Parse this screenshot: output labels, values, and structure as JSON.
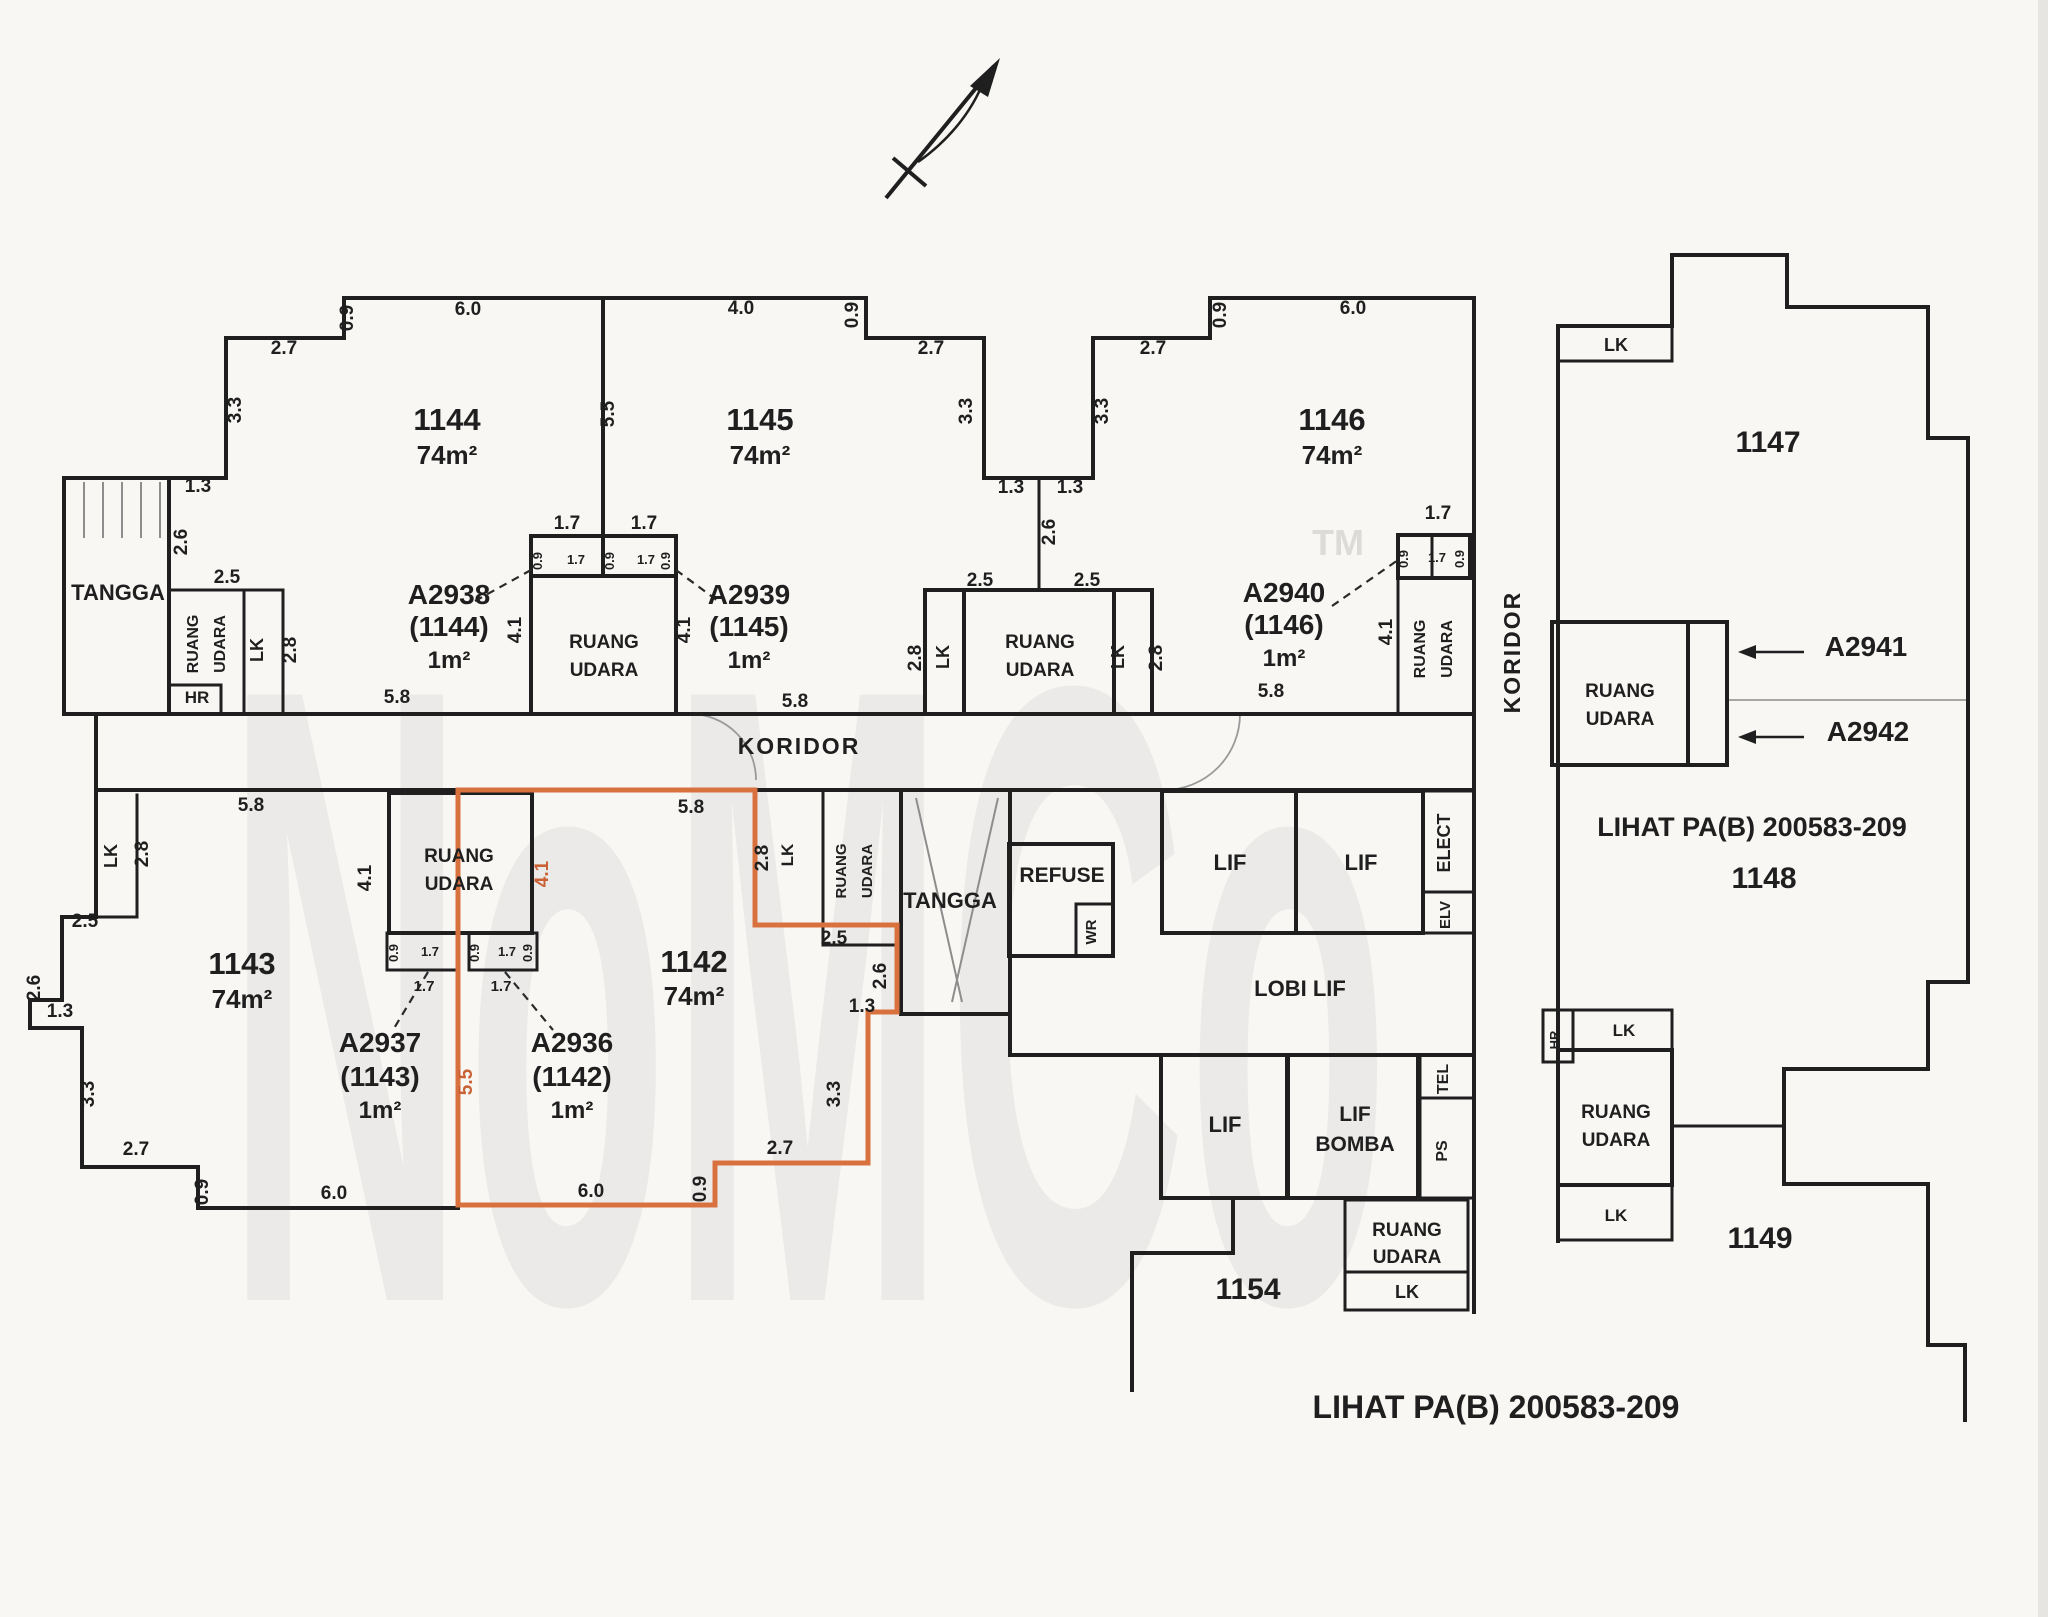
{
  "palette": {
    "ink": "#1f1f1f",
    "boundary": "#c96135",
    "muted": "#9a9a9a",
    "paper": "#f8f7f4"
  },
  "watermark": {
    "text": "NoMCo",
    "tm": "TM"
  },
  "notes": {
    "right_reference": "LIHAT PA(B) 200583-209",
    "bottom_reference": "LIHAT PA(B) 200583-209"
  },
  "units_summary": [
    {
      "id": "1144",
      "area": "74m²",
      "accessory": "A2938 (1144) 1m²"
    },
    {
      "id": "1145",
      "area": "74m²",
      "accessory": "A2939 (1145) 1m²"
    },
    {
      "id": "1146",
      "area": "74m²",
      "accessory": "A2940 (1146) 1m²"
    },
    {
      "id": "1143",
      "area": "74m²",
      "accessory": "A2937 (1143) 1m²"
    },
    {
      "id": "1142",
      "area": "74m²",
      "accessory": "A2936 (1142) 1m²",
      "highlighted": true
    },
    {
      "id": "1147"
    },
    {
      "id": "1148"
    },
    {
      "id": "1149"
    },
    {
      "id": "1154"
    }
  ],
  "labels": [
    {
      "n": "unit-1144-number",
      "t": "1144",
      "x": 447,
      "y": 430,
      "s": 31
    },
    {
      "n": "unit-1144-area",
      "t": "74m²",
      "x": 447,
      "y": 464,
      "s": 26
    },
    {
      "n": "unit-1145-number",
      "t": "1145",
      "x": 760,
      "y": 430,
      "s": 31
    },
    {
      "n": "unit-1145-area",
      "t": "74m²",
      "x": 760,
      "y": 464,
      "s": 26
    },
    {
      "n": "unit-1146-number",
      "t": "1146",
      "x": 1332,
      "y": 430,
      "s": 31
    },
    {
      "n": "unit-1146-area",
      "t": "74m²",
      "x": 1332,
      "y": 464,
      "s": 26
    },
    {
      "n": "unit-1147-number",
      "t": "1147",
      "x": 1768,
      "y": 452,
      "s": 30
    },
    {
      "n": "unit-1148-number",
      "t": "1148",
      "x": 1764,
      "y": 888,
      "s": 30
    },
    {
      "n": "unit-1149-number",
      "t": "1149",
      "x": 1760,
      "y": 1248,
      "s": 30
    },
    {
      "n": "unit-1154-number",
      "t": "1154",
      "x": 1248,
      "y": 1299,
      "s": 30
    },
    {
      "n": "unit-1143-number",
      "t": "1143",
      "x": 242,
      "y": 974,
      "s": 31
    },
    {
      "n": "unit-1143-area",
      "t": "74m²",
      "x": 242,
      "y": 1008,
      "s": 26
    },
    {
      "n": "unit-1142-number",
      "t": "1142",
      "x": 694,
      "y": 972,
      "s": 31
    },
    {
      "n": "unit-1142-area",
      "t": "74m²",
      "x": 694,
      "y": 1005,
      "s": 26
    },
    {
      "n": "accessory-a2938",
      "t": "A2938",
      "x": 449,
      "y": 604,
      "s": 28
    },
    {
      "n": "accessory-a2938-unit",
      "t": "(1144)",
      "x": 449,
      "y": 636,
      "s": 28
    },
    {
      "n": "accessory-a2938-area",
      "t": "1m²",
      "x": 449,
      "y": 668,
      "s": 24
    },
    {
      "n": "accessory-a2939",
      "t": "A2939",
      "x": 749,
      "y": 604,
      "s": 28
    },
    {
      "n": "accessory-a2939-unit",
      "t": "(1145)",
      "x": 749,
      "y": 636,
      "s": 28
    },
    {
      "n": "accessory-a2939-area",
      "t": "1m²",
      "x": 749,
      "y": 668,
      "s": 24
    },
    {
      "n": "accessory-a2940",
      "t": "A2940",
      "x": 1284,
      "y": 602,
      "s": 28
    },
    {
      "n": "accessory-a2940-unit",
      "t": "(1146)",
      "x": 1284,
      "y": 634,
      "s": 28
    },
    {
      "n": "accessory-a2940-area",
      "t": "1m²",
      "x": 1284,
      "y": 666,
      "s": 24
    },
    {
      "n": "accessory-a2937",
      "t": "A2937",
      "x": 380,
      "y": 1052,
      "s": 28
    },
    {
      "n": "accessory-a2937-unit",
      "t": "(1143)",
      "x": 380,
      "y": 1086,
      "s": 28
    },
    {
      "n": "accessory-a2937-area",
      "t": "1m²",
      "x": 380,
      "y": 1118,
      "s": 24
    },
    {
      "n": "accessory-a2936",
      "t": "A2936",
      "x": 572,
      "y": 1052,
      "s": 28
    },
    {
      "n": "accessory-a2936-unit",
      "t": "(1142)",
      "x": 572,
      "y": 1086,
      "s": 28
    },
    {
      "n": "accessory-a2936-area",
      "t": "1m²",
      "x": 572,
      "y": 1118,
      "s": 24
    },
    {
      "n": "accessory-a2941",
      "t": "A2941",
      "x": 1866,
      "y": 656,
      "s": 28
    },
    {
      "n": "accessory-a2942",
      "t": "A2942",
      "x": 1868,
      "y": 741,
      "s": 28
    },
    {
      "n": "room-tangga-top",
      "t": "TANGGA",
      "x": 118,
      "y": 600,
      "s": 22
    },
    {
      "n": "room-tangga-bottom",
      "t": "TANGGA",
      "x": 950,
      "y": 908,
      "s": 22
    },
    {
      "n": "room-refuse",
      "t": "REFUSE",
      "x": 1062,
      "y": 882,
      "s": 21
    },
    {
      "n": "room-wr",
      "t": "WR",
      "x": 1096,
      "y": 932,
      "r": -90,
      "s": 15
    },
    {
      "n": "room-lif-1",
      "t": "LIF",
      "x": 1230,
      "y": 870,
      "s": 22
    },
    {
      "n": "room-lif-2",
      "t": "LIF",
      "x": 1361,
      "y": 870,
      "s": 22
    },
    {
      "n": "room-elect",
      "t": "ELECT",
      "x": 1450,
      "y": 843,
      "r": -90,
      "s": 18
    },
    {
      "n": "room-elv",
      "t": "ELV",
      "x": 1450,
      "y": 915,
      "r": -90,
      "s": 15
    },
    {
      "n": "room-lobi-lif",
      "t": "LOBI LIF",
      "x": 1300,
      "y": 996,
      "s": 22
    },
    {
      "n": "room-tel",
      "t": "TEL",
      "x": 1448,
      "y": 1079,
      "r": -90,
      "s": 16
    },
    {
      "n": "room-lif-3",
      "t": "LIF",
      "x": 1225,
      "y": 1132,
      "s": 22
    },
    {
      "n": "room-lif-bomba-1",
      "t": "LIF",
      "x": 1355,
      "y": 1121,
      "s": 21
    },
    {
      "n": "room-lif-bomba-2",
      "t": "BOMBA",
      "x": 1355,
      "y": 1151,
      "s": 21
    },
    {
      "n": "room-ps",
      "t": "PS",
      "x": 1447,
      "y": 1151,
      "r": -90,
      "s": 16
    },
    {
      "n": "room-ruang-udara-s1",
      "t": "RUANG",
      "x": 1407,
      "y": 1236,
      "s": 19
    },
    {
      "n": "room-ruang-udara-s2",
      "t": "UDARA",
      "x": 1407,
      "y": 1263,
      "s": 19
    },
    {
      "n": "room-lk-s",
      "t": "LK",
      "x": 1407,
      "y": 1298,
      "s": 18
    },
    {
      "n": "corridor-label-h",
      "t": "KORIDOR",
      "x": 799,
      "y": 754,
      "s": 23,
      "ls": 2
    },
    {
      "n": "corridor-label-v",
      "t": "KORIDOR",
      "x": 1520,
      "y": 652,
      "r": -90,
      "s": 23,
      "ls": 2
    },
    {
      "n": "room-hr-top",
      "t": "HR",
      "x": 197,
      "y": 703,
      "s": 17
    },
    {
      "n": "room-lk-1144",
      "t": "LK",
      "x": 263,
      "y": 650,
      "r": -90,
      "s": 18
    },
    {
      "n": "ruang-udara-1144a",
      "t": "RUANG",
      "x": 198,
      "y": 644,
      "r": -90,
      "s": 16
    },
    {
      "n": "ruang-udara-1144b",
      "t": "UDARA",
      "x": 225,
      "y": 644,
      "r": -90,
      "s": 16
    },
    {
      "n": "ruang-udara-c1a",
      "t": "RUANG",
      "x": 604,
      "y": 648,
      "s": 19
    },
    {
      "n": "ruang-udara-c1b",
      "t": "UDARA",
      "x": 604,
      "y": 676,
      "s": 19
    },
    {
      "n": "room-lk-1145a",
      "t": "LK",
      "x": 949,
      "y": 657,
      "r": -90,
      "s": 18
    },
    {
      "n": "ruang-udara-c2a",
      "t": "RUANG",
      "x": 1040,
      "y": 648,
      "s": 19
    },
    {
      "n": "ruang-udara-c2b",
      "t": "UDARA",
      "x": 1040,
      "y": 676,
      "s": 19
    },
    {
      "n": "room-lk-1145b",
      "t": "LK",
      "x": 1124,
      "y": 657,
      "r": -90,
      "s": 18
    },
    {
      "n": "ruang-udara-1146a",
      "t": "RUANG",
      "x": 1425,
      "y": 649,
      "r": -90,
      "s": 16
    },
    {
      "n": "ruang-udara-1146b",
      "t": "UDARA",
      "x": 1452,
      "y": 649,
      "r": -90,
      "s": 16
    },
    {
      "n": "ruang-udara-1147a",
      "t": "RUANG",
      "x": 1620,
      "y": 697,
      "s": 19
    },
    {
      "n": "ruang-udara-1147b",
      "t": "UDARA",
      "x": 1620,
      "y": 725,
      "s": 19
    },
    {
      "n": "room-lk-1147",
      "t": "LK",
      "x": 1616,
      "y": 351,
      "s": 18
    },
    {
      "n": "room-lk-1143",
      "t": "LK",
      "x": 117,
      "y": 856,
      "r": -90,
      "s": 18
    },
    {
      "n": "ruang-udara-1143a",
      "t": "RUANG",
      "x": 459,
      "y": 862,
      "s": 19
    },
    {
      "n": "ruang-udara-1143b",
      "t": "UDARA",
      "x": 459,
      "y": 890,
      "s": 19
    },
    {
      "n": "room-lk-1142",
      "t": "LK",
      "x": 793,
      "y": 855,
      "r": -90,
      "s": 17
    },
    {
      "n": "ruang-udara-1142a",
      "t": "RUANG",
      "x": 846,
      "y": 871,
      "r": -90,
      "s": 15
    },
    {
      "n": "ruang-udara-1142b",
      "t": "UDARA",
      "x": 872,
      "y": 871,
      "r": -90,
      "s": 15
    },
    {
      "n": "room-hr-right",
      "t": "HR",
      "x": 1559,
      "y": 1040,
      "r": -90,
      "s": 13
    },
    {
      "n": "room-lk-r1",
      "t": "LK",
      "x": 1624,
      "y": 1036,
      "s": 17
    },
    {
      "n": "ruang-udara-r1",
      "t": "RUANG",
      "x": 1616,
      "y": 1118,
      "s": 19
    },
    {
      "n": "ruang-udara-r2",
      "t": "UDARA",
      "x": 1616,
      "y": 1146,
      "s": 19
    },
    {
      "n": "room-lk-r2",
      "t": "LK",
      "x": 1616,
      "y": 1221,
      "s": 17
    },
    {
      "n": "note-right",
      "t": "LIHAT PA(B) 200583-209",
      "x": 1752,
      "y": 836,
      "s": 27
    },
    {
      "n": "note-bottom",
      "t": "LIHAT PA(B) 200583-209",
      "x": 1496,
      "y": 1418,
      "s": 32
    },
    {
      "n": "dim",
      "t": "0.9",
      "x": 353,
      "y": 318,
      "r": -90,
      "s": 19
    },
    {
      "n": "dim",
      "t": "6.0",
      "x": 468,
      "y": 315,
      "s": 19
    },
    {
      "n": "dim",
      "t": "2.7",
      "x": 284,
      "y": 354,
      "s": 19
    },
    {
      "n": "dim",
      "t": "3.3",
      "x": 241,
      "y": 410,
      "r": -90,
      "s": 19
    },
    {
      "n": "dim",
      "t": "1.3",
      "x": 198,
      "y": 492,
      "s": 19
    },
    {
      "n": "dim",
      "t": "2.6",
      "x": 187,
      "y": 542,
      "r": -90,
      "s": 19
    },
    {
      "n": "dim",
      "t": "2.5",
      "x": 227,
      "y": 583,
      "s": 19
    },
    {
      "n": "dim",
      "t": "2.8",
      "x": 296,
      "y": 650,
      "r": -90,
      "s": 19
    },
    {
      "n": "dim",
      "t": "5.8",
      "x": 397,
      "y": 703,
      "s": 19
    },
    {
      "n": "dim",
      "t": "5.5",
      "x": 614,
      "y": 414,
      "r": -90,
      "s": 19
    },
    {
      "n": "dim",
      "t": "1.7",
      "x": 567,
      "y": 529,
      "s": 19
    },
    {
      "n": "dim",
      "t": "1.7",
      "x": 644,
      "y": 529,
      "s": 19
    },
    {
      "n": "dim",
      "t": "0.9",
      "x": 542,
      "y": 561,
      "r": -90,
      "s": 13
    },
    {
      "n": "dim",
      "t": "1.7",
      "x": 576,
      "y": 564,
      "s": 13
    },
    {
      "n": "dim",
      "t": "0.9",
      "x": 614,
      "y": 561,
      "r": -90,
      "s": 13
    },
    {
      "n": "dim",
      "t": "1.7",
      "x": 646,
      "y": 564,
      "s": 13
    },
    {
      "n": "dim",
      "t": "0.9",
      "x": 670,
      "y": 561,
      "r": -90,
      "s": 13
    },
    {
      "n": "dim",
      "t": "4.1",
      "x": 521,
      "y": 630,
      "r": -90,
      "s": 19
    },
    {
      "n": "dim",
      "t": "4.1",
      "x": 690,
      "y": 630,
      "r": -90,
      "s": 19
    },
    {
      "n": "dim",
      "t": "4.0",
      "x": 741,
      "y": 314,
      "s": 19
    },
    {
      "n": "dim",
      "t": "0.9",
      "x": 858,
      "y": 315,
      "r": -90,
      "s": 19
    },
    {
      "n": "dim",
      "t": "2.7",
      "x": 931,
      "y": 354,
      "s": 19
    },
    {
      "n": "dim",
      "t": "3.3",
      "x": 972,
      "y": 411,
      "r": -90,
      "s": 19
    },
    {
      "n": "dim",
      "t": "1.3",
      "x": 1011,
      "y": 493,
      "s": 19
    },
    {
      "n": "dim",
      "t": "1.3",
      "x": 1070,
      "y": 493,
      "s": 19
    },
    {
      "n": "dim",
      "t": "2.6",
      "x": 1055,
      "y": 532,
      "r": -90,
      "s": 19
    },
    {
      "n": "dim",
      "t": "2.5",
      "x": 980,
      "y": 586,
      "s": 19
    },
    {
      "n": "dim",
      "t": "2.5",
      "x": 1087,
      "y": 586,
      "s": 19
    },
    {
      "n": "dim",
      "t": "2.8",
      "x": 921,
      "y": 658,
      "r": -90,
      "s": 19
    },
    {
      "n": "dim",
      "t": "2.8",
      "x": 1162,
      "y": 658,
      "r": -90,
      "s": 19
    },
    {
      "n": "dim",
      "t": "5.8",
      "x": 795,
      "y": 707,
      "s": 19
    },
    {
      "n": "dim",
      "t": "0.9",
      "x": 1226,
      "y": 315,
      "r": -90,
      "s": 19
    },
    {
      "n": "dim",
      "t": "6.0",
      "x": 1353,
      "y": 314,
      "s": 19
    },
    {
      "n": "dim",
      "t": "2.7",
      "x": 1153,
      "y": 354,
      "s": 19
    },
    {
      "n": "dim",
      "t": "3.3",
      "x": 1108,
      "y": 411,
      "r": -90,
      "s": 19
    },
    {
      "n": "dim",
      "t": "1.7",
      "x": 1438,
      "y": 519,
      "s": 19
    },
    {
      "n": "dim",
      "t": "0.9",
      "x": 1408,
      "y": 559,
      "r": -90,
      "s": 13
    },
    {
      "n": "dim",
      "t": "1.7",
      "x": 1437,
      "y": 562,
      "s": 13
    },
    {
      "n": "dim",
      "t": "0.9",
      "x": 1464,
      "y": 559,
      "r": -90,
      "s": 13
    },
    {
      "n": "dim",
      "t": "4.1",
      "x": 1392,
      "y": 632,
      "r": -90,
      "s": 19
    },
    {
      "n": "dim",
      "t": "5.8",
      "x": 1271,
      "y": 697,
      "s": 19
    },
    {
      "n": "dim",
      "t": "5.8",
      "x": 251,
      "y": 811,
      "s": 19
    },
    {
      "n": "dim",
      "t": "2.8",
      "x": 148,
      "y": 854,
      "r": -90,
      "s": 19
    },
    {
      "n": "dim",
      "t": "2.5",
      "x": 85,
      "y": 927,
      "s": 19
    },
    {
      "n": "dim",
      "t": "2.6",
      "x": 40,
      "y": 988,
      "r": -90,
      "s": 19
    },
    {
      "n": "dim",
      "t": "1.3",
      "x": 60,
      "y": 1017,
      "s": 19
    },
    {
      "n": "dim",
      "t": "3.3",
      "x": 94,
      "y": 1094,
      "r": -90,
      "s": 19
    },
    {
      "n": "dim",
      "t": "2.7",
      "x": 136,
      "y": 1155,
      "s": 19
    },
    {
      "n": "dim",
      "t": "0.9",
      "x": 208,
      "y": 1192,
      "r": -90,
      "s": 19
    },
    {
      "n": "dim",
      "t": "6.0",
      "x": 334,
      "y": 1199,
      "s": 19
    },
    {
      "n": "dim",
      "t": "4.1",
      "x": 371,
      "y": 878,
      "r": -90,
      "s": 19
    },
    {
      "n": "dim",
      "t": "0.9",
      "x": 398,
      "y": 953,
      "r": -90,
      "s": 13
    },
    {
      "n": "dim",
      "t": "1.7",
      "x": 430,
      "y": 956,
      "s": 13
    },
    {
      "n": "dim",
      "t": "1.7",
      "x": 424,
      "y": 991,
      "s": 15
    },
    {
      "n": "dim",
      "t": "0.9",
      "x": 479,
      "y": 953,
      "r": -90,
      "s": 13
    },
    {
      "n": "dim",
      "t": "1.7",
      "x": 507,
      "y": 956,
      "s": 13
    },
    {
      "n": "dim",
      "t": "0.9",
      "x": 532,
      "y": 953,
      "r": -90,
      "s": 13
    },
    {
      "n": "dim",
      "t": "1.7",
      "x": 501,
      "y": 991,
      "s": 15
    },
    {
      "n": "dim",
      "t": "5.8",
      "x": 691,
      "y": 813,
      "s": 19
    },
    {
      "n": "dim",
      "t": "2.8",
      "x": 768,
      "y": 858,
      "r": -90,
      "s": 19
    },
    {
      "n": "dim",
      "t": "2.5",
      "x": 834,
      "y": 944,
      "s": 19
    },
    {
      "n": "dim",
      "t": "2.6",
      "x": 886,
      "y": 976,
      "r": -90,
      "s": 19
    },
    {
      "n": "dim",
      "t": "1.3",
      "x": 862,
      "y": 1012,
      "s": 19
    },
    {
      "n": "dim",
      "t": "3.3",
      "x": 840,
      "y": 1094,
      "r": -90,
      "s": 19
    },
    {
      "n": "dim",
      "t": "2.7",
      "x": 780,
      "y": 1154,
      "s": 19
    },
    {
      "n": "dim",
      "t": "0.9",
      "x": 706,
      "y": 1189,
      "r": -90,
      "s": 19
    },
    {
      "n": "dim",
      "t": "6.0",
      "x": 591,
      "y": 1197,
      "s": 19
    },
    {
      "n": "dim-boundary",
      "t": "5.5",
      "x": 472,
      "y": 1082,
      "r": -90,
      "s": 19,
      "c": "boundary"
    },
    {
      "n": "dim-boundary",
      "t": "4.1",
      "x": 548,
      "y": 874,
      "r": -90,
      "s": 19,
      "c": "boundary"
    }
  ]
}
